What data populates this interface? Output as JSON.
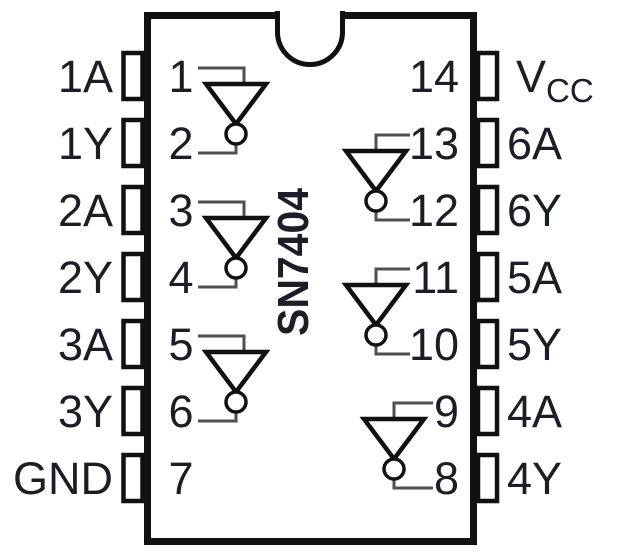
{
  "chip": {
    "part_number": "SN7404"
  },
  "left_pins": [
    {
      "number": "1",
      "label": "1A"
    },
    {
      "number": "2",
      "label": "1Y"
    },
    {
      "number": "3",
      "label": "2A"
    },
    {
      "number": "4",
      "label": "2Y"
    },
    {
      "number": "5",
      "label": "3A"
    },
    {
      "number": "6",
      "label": "3Y"
    },
    {
      "number": "7",
      "label": "GND"
    }
  ],
  "right_pins": [
    {
      "number": "14",
      "label": "VCC",
      "label_main": "V",
      "label_sub": "CC"
    },
    {
      "number": "13",
      "label": "6A"
    },
    {
      "number": "12",
      "label": "6Y"
    },
    {
      "number": "11",
      "label": "5A"
    },
    {
      "number": "10",
      "label": "5Y"
    },
    {
      "number": "9",
      "label": "4A"
    },
    {
      "number": "8",
      "label": "4Y"
    }
  ],
  "inverters": [
    {
      "input_pin": "1",
      "output_pin": "2"
    },
    {
      "input_pin": "3",
      "output_pin": "4"
    },
    {
      "input_pin": "5",
      "output_pin": "6"
    },
    {
      "input_pin": "13",
      "output_pin": "12"
    },
    {
      "input_pin": "11",
      "output_pin": "10"
    },
    {
      "input_pin": "9",
      "output_pin": "8"
    }
  ],
  "colors": {
    "outline_ink": "#111111",
    "wire_gray": "#4f4f4f",
    "text_ink": "#1d1d28",
    "background": "#ffffff"
  }
}
